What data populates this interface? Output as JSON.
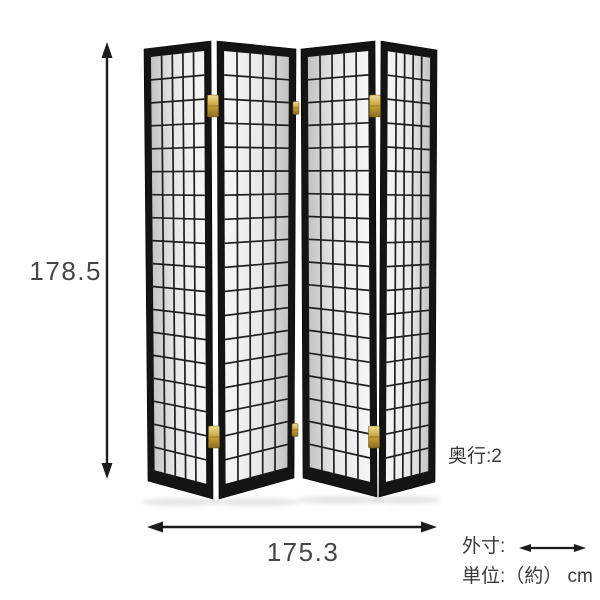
{
  "figure": {
    "title": "4-panel shoji folding screen dimension diagram",
    "dimensions": {
      "height": "178.5",
      "width": "175.3",
      "depth": "奥行:2",
      "legend": "外寸:",
      "unit": "単位:（約） cm"
    },
    "colors": {
      "background": "#ffffff",
      "frame": "#141414",
      "frame_stroke": "#000000",
      "lattice": "#1f1f1f",
      "paper_dark": "#c2c2c2",
      "paper_mid": "#e8e8e8",
      "paper_light": "#f6f6f6",
      "hinge_gold_light": "#eedd96",
      "hinge_gold": "#c9a233",
      "hinge_gold_dark": "#8a6d1f",
      "annotation": "#1c1c1c",
      "label_text": "#3e3e3e"
    },
    "screen": {
      "grid": {
        "cols": 5,
        "rows": 18
      },
      "frame_inset": {
        "top": 9,
        "side": 7,
        "bottom": 13
      },
      "panels": [
        {
          "name": "screen-panel-1",
          "shade": "dark-left",
          "quad": [
            [
              144,
              49
            ],
            [
              211,
              41
            ],
            [
              213,
              499
            ],
            [
              148,
              481
            ]
          ]
        },
        {
          "name": "screen-panel-2",
          "shade": "dark-right",
          "quad": [
            [
              217,
              41
            ],
            [
              296,
              49
            ],
            [
              294,
              478
            ],
            [
              219,
              499
            ]
          ]
        },
        {
          "name": "screen-panel-3",
          "shade": "dark-left",
          "quad": [
            [
              301,
              49
            ],
            [
              375,
              41
            ],
            [
              377,
              497
            ],
            [
              303,
              478
            ]
          ]
        },
        {
          "name": "screen-panel-4",
          "shade": "dark-right",
          "quad": [
            [
              381,
              41
            ],
            [
              437,
              50
            ],
            [
              435,
              482
            ],
            [
              379,
              497
            ]
          ]
        }
      ],
      "hinges": [
        {
          "x": 213,
          "y": 106,
          "w": 11,
          "h": 22,
          "size": "large"
        },
        {
          "x": 214,
          "y": 437,
          "w": 11,
          "h": 22,
          "size": "large"
        },
        {
          "x": 375,
          "y": 106,
          "w": 11,
          "h": 22,
          "size": "large"
        },
        {
          "x": 374,
          "y": 437,
          "w": 11,
          "h": 22,
          "size": "large"
        },
        {
          "x": 296,
          "y": 108,
          "w": 6,
          "h": 13,
          "size": "small"
        },
        {
          "x": 295,
          "y": 430,
          "w": 6,
          "h": 13,
          "size": "small"
        }
      ]
    },
    "arrows": {
      "height": {
        "from": [
          107,
          42
        ],
        "to": [
          107,
          479
        ],
        "line_width": 2.4,
        "head_l": 16,
        "head_w": 11
      },
      "width": {
        "from": [
          147,
          527
        ],
        "to": [
          437,
          527
        ],
        "line_width": 2.4,
        "head_l": 16,
        "head_w": 11
      },
      "legend": {
        "from": [
          519,
          548
        ],
        "to": [
          586,
          548
        ],
        "line_width": 2.2,
        "head_l": 12,
        "head_w": 8
      }
    }
  }
}
